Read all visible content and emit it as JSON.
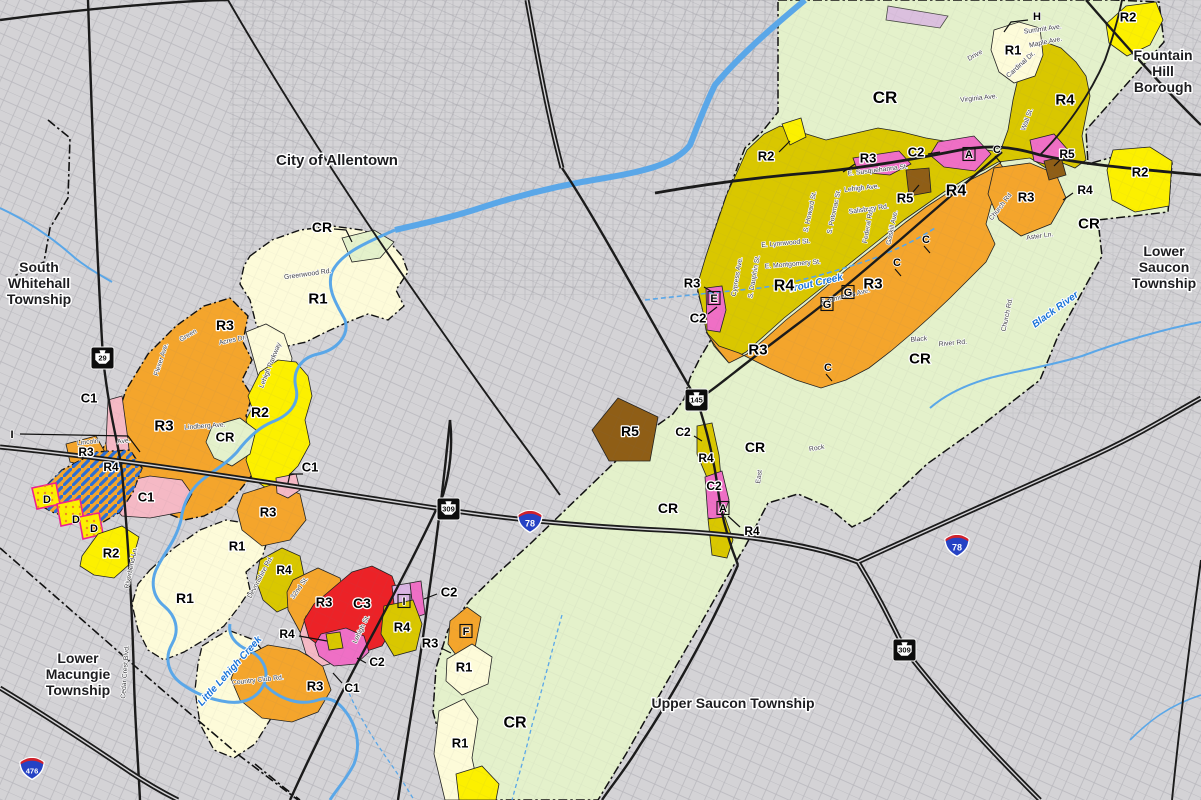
{
  "colors": {
    "background": "#d4d3d6",
    "road": "#1b1b1b",
    "water": "#5aa7e8",
    "grid": "#9b9ba1",
    "boundary": "#111111",
    "hatch_stripe": "#2b6fd6",
    "dot_overlay": "#f08c1e",
    "overlay_border": "#ef1f8f",
    "zones": {
      "CR": "#e4f1cb",
      "R1": "#fdfbd9",
      "R2": "#fcf000",
      "R3": "#f4a52c",
      "R4": "#d9c700",
      "R5": "#8f5e16",
      "C1": "#f5b9c5",
      "C2": "#ef6fc5",
      "C3": "#ec2227",
      "I": "#d9b4e3"
    }
  },
  "townships": [
    {
      "name": "City of Allentown",
      "lines": [
        "City of Allentown"
      ],
      "x": 337,
      "y": 165,
      "size": 15
    },
    {
      "name": "South Whitehall Township",
      "lines": [
        "South",
        "Whitehall",
        "Township"
      ],
      "x": 39,
      "y": 272,
      "size": 14
    },
    {
      "name": "Fountain Hill Borough",
      "lines": [
        "Fountain",
        "Hill",
        "Borough"
      ],
      "x": 1163,
      "y": 60,
      "size": 14
    },
    {
      "name": "Lower Saucon Township",
      "lines": [
        "Lower",
        "Saucon",
        "Township"
      ],
      "x": 1164,
      "y": 256,
      "size": 14
    },
    {
      "name": "Lower Macungie Township",
      "lines": [
        "Lower",
        "Macungie",
        "Township"
      ],
      "x": 78,
      "y": 663,
      "size": 14
    },
    {
      "name": "Upper Saucon Township",
      "lines": [
        "Upper Saucon Township"
      ],
      "x": 733,
      "y": 708,
      "size": 14
    }
  ],
  "zone_labels": [
    {
      "t": "CR",
      "x": 885,
      "y": 97,
      "s": 17
    },
    {
      "t": "R4",
      "x": 1065,
      "y": 99,
      "s": 15
    },
    {
      "t": "R1",
      "x": 1013,
      "y": 50,
      "s": 13
    },
    {
      "t": "R2",
      "x": 1128,
      "y": 17,
      "s": 13
    },
    {
      "t": "R2",
      "x": 766,
      "y": 156,
      "s": 13,
      "ptr": [
        [
          779,
          152
        ],
        [
          790,
          141
        ]
      ]
    },
    {
      "t": "R3",
      "x": 868,
      "y": 158,
      "s": 13,
      "ptr": [
        [
          855,
          164
        ],
        [
          843,
          172
        ]
      ]
    },
    {
      "t": "C2",
      "x": 916,
      "y": 152,
      "s": 13,
      "ptr": [
        [
          928,
          154
        ],
        [
          940,
          152
        ]
      ]
    },
    {
      "t": "R5",
      "x": 905,
      "y": 198,
      "s": 13,
      "ptr": [
        [
          913,
          192
        ],
        [
          919,
          185
        ]
      ]
    },
    {
      "t": "R5",
      "x": 1067,
      "y": 154,
      "s": 12,
      "ptr": [
        [
          1060,
          160
        ],
        [
          1054,
          166
        ]
      ]
    },
    {
      "t": "R4",
      "x": 956,
      "y": 190,
      "s": 16
    },
    {
      "t": "R3",
      "x": 1026,
      "y": 197,
      "s": 13
    },
    {
      "t": "R4",
      "x": 1085,
      "y": 190,
      "s": 12,
      "ptr": [
        [
          1073,
          193
        ],
        [
          1063,
          200
        ]
      ]
    },
    {
      "t": "R2",
      "x": 1140,
      "y": 172,
      "s": 13
    },
    {
      "t": "CR",
      "x": 1089,
      "y": 223,
      "s": 15
    },
    {
      "t": "R3",
      "x": 692,
      "y": 283,
      "s": 13,
      "ptr": [
        [
          704,
          287
        ],
        [
          714,
          293
        ]
      ]
    },
    {
      "t": "C2",
      "x": 698,
      "y": 318,
      "s": 13,
      "ptr": [
        [
          708,
          314
        ],
        [
          717,
          307
        ]
      ]
    },
    {
      "t": "R4",
      "x": 784,
      "y": 285,
      "s": 16
    },
    {
      "t": "R3",
      "x": 873,
      "y": 283,
      "s": 15
    },
    {
      "t": "R3",
      "x": 758,
      "y": 349,
      "s": 15
    },
    {
      "t": "CR",
      "x": 920,
      "y": 358,
      "s": 15
    },
    {
      "t": "R5",
      "x": 630,
      "y": 431,
      "s": 14
    },
    {
      "t": "C2",
      "x": 683,
      "y": 432,
      "s": 12,
      "ptr": [
        [
          694,
          436
        ],
        [
          702,
          441
        ]
      ]
    },
    {
      "t": "R4",
      "x": 706,
      "y": 458,
      "s": 12
    },
    {
      "t": "C2",
      "x": 714,
      "y": 486,
      "s": 12
    },
    {
      "t": "CR",
      "x": 755,
      "y": 447,
      "s": 14
    },
    {
      "t": "CR",
      "x": 668,
      "y": 508,
      "s": 14
    },
    {
      "t": "R4",
      "x": 752,
      "y": 531,
      "s": 12,
      "ptr": [
        [
          740,
          527
        ],
        [
          728,
          516
        ]
      ]
    },
    {
      "t": "CR",
      "x": 515,
      "y": 722,
      "s": 16
    },
    {
      "t": "R1",
      "x": 464,
      "y": 667,
      "s": 13
    },
    {
      "t": "R1",
      "x": 460,
      "y": 743,
      "s": 13
    },
    {
      "t": "R3",
      "x": 430,
      "y": 643,
      "s": 13,
      "ptr": [
        [
          441,
          648
        ],
        [
          451,
          653
        ]
      ]
    },
    {
      "t": "C2",
      "x": 449,
      "y": 592,
      "s": 13,
      "ptr": [
        [
          437,
          594
        ],
        [
          424,
          599
        ]
      ]
    },
    {
      "t": "R4",
      "x": 402,
      "y": 627,
      "s": 13
    },
    {
      "t": "C3",
      "x": 362,
      "y": 603,
      "s": 14
    },
    {
      "t": "R3",
      "x": 324,
      "y": 602,
      "s": 13
    },
    {
      "t": "R4",
      "x": 287,
      "y": 634,
      "s": 12,
      "ptr": [
        [
          299,
          636
        ],
        [
          327,
          641
        ]
      ]
    },
    {
      "t": "C2",
      "x": 377,
      "y": 662,
      "s": 12,
      "ptr": [
        [
          366,
          663
        ],
        [
          357,
          658
        ]
      ]
    },
    {
      "t": "C1",
      "x": 352,
      "y": 688,
      "s": 12,
      "ptr": [
        [
          342,
          683
        ],
        [
          333,
          673
        ]
      ]
    },
    {
      "t": "R3",
      "x": 315,
      "y": 686,
      "s": 13
    },
    {
      "t": "R4",
      "x": 284,
      "y": 570,
      "s": 12
    },
    {
      "t": "R3",
      "x": 268,
      "y": 512,
      "s": 13
    },
    {
      "t": "C1",
      "x": 310,
      "y": 467,
      "s": 13,
      "ptr": [
        [
          303,
          474
        ],
        [
          290,
          474
        ],
        [
          288,
          483
        ]
      ]
    },
    {
      "t": "C1",
      "x": 146,
      "y": 497,
      "s": 13
    },
    {
      "t": "R2",
      "x": 111,
      "y": 553,
      "s": 13
    },
    {
      "t": "R1",
      "x": 237,
      "y": 546,
      "s": 13
    },
    {
      "t": "R1",
      "x": 185,
      "y": 598,
      "s": 14
    },
    {
      "t": "R2",
      "x": 260,
      "y": 412,
      "s": 14
    },
    {
      "t": "CR",
      "x": 225,
      "y": 437,
      "s": 13
    },
    {
      "t": "R3",
      "x": 164,
      "y": 425,
      "s": 15
    },
    {
      "t": "R3",
      "x": 225,
      "y": 325,
      "s": 14
    },
    {
      "t": "C1",
      "x": 89,
      "y": 398,
      "s": 13
    },
    {
      "t": "R3",
      "x": 86,
      "y": 452,
      "s": 12
    },
    {
      "t": "R4",
      "x": 111,
      "y": 467,
      "s": 12
    },
    {
      "t": "R1",
      "x": 318,
      "y": 298,
      "s": 15
    },
    {
      "t": "CR",
      "x": 322,
      "y": 227,
      "s": 14,
      "ptr": [
        [
          334,
          229
        ],
        [
          346,
          230
        ],
        [
          352,
          242
        ]
      ]
    }
  ],
  "letter_markers": [
    {
      "t": "H",
      "x": 1037,
      "y": 16,
      "kind": "plain",
      "ptr": [
        [
          1028,
          20
        ],
        [
          1011,
          22
        ],
        [
          1004,
          32
        ]
      ]
    },
    {
      "t": "I",
      "x": 12,
      "y": 434,
      "kind": "plain",
      "ptr": [
        [
          20,
          434
        ],
        [
          128,
          436
        ],
        [
          140,
          452
        ]
      ]
    },
    {
      "t": "A",
      "x": 969,
      "y": 154,
      "kind": "boxed"
    },
    {
      "t": "C",
      "x": 997,
      "y": 149,
      "kind": "tick"
    },
    {
      "t": "C",
      "x": 926,
      "y": 239,
      "kind": "tick"
    },
    {
      "t": "C",
      "x": 897,
      "y": 262,
      "kind": "tick"
    },
    {
      "t": "C",
      "x": 828,
      "y": 367,
      "kind": "tick"
    },
    {
      "t": "G",
      "x": 848,
      "y": 292,
      "kind": "boxed"
    },
    {
      "t": "G",
      "x": 827,
      "y": 304,
      "kind": "boxed"
    },
    {
      "t": "E",
      "x": 714,
      "y": 298,
      "kind": "boxed"
    },
    {
      "t": "A",
      "x": 723,
      "y": 508,
      "kind": "boxed"
    },
    {
      "t": "F",
      "x": 466,
      "y": 631,
      "kind": "boxed"
    },
    {
      "t": "I",
      "x": 404,
      "y": 601,
      "kind": "boxed"
    },
    {
      "t": "D",
      "x": 47,
      "y": 499,
      "kind": "plain"
    },
    {
      "t": "D",
      "x": 76,
      "y": 519,
      "kind": "plain"
    },
    {
      "t": "D",
      "x": 94,
      "y": 528,
      "kind": "plain"
    }
  ],
  "street_labels": [
    {
      "t": "Greenwood Rd.",
      "x": 308,
      "y": 276,
      "r": -8
    },
    {
      "t": "Flexer Ave.",
      "x": 163,
      "y": 360,
      "r": -72
    },
    {
      "t": "Green",
      "x": 189,
      "y": 337,
      "r": -30
    },
    {
      "t": "Acres Dr.",
      "x": 233,
      "y": 342,
      "r": -12
    },
    {
      "t": "Lehigh Parkway",
      "x": 272,
      "y": 366,
      "r": -68
    },
    {
      "t": "Lindberg Ave.",
      "x": 205,
      "y": 428,
      "r": -4
    },
    {
      "t": "Lincoln",
      "x": 88,
      "y": 444,
      "r": -6
    },
    {
      "t": "Ave.",
      "x": 124,
      "y": 443,
      "r": -6
    },
    {
      "t": "32nd St.",
      "x": 301,
      "y": 589,
      "r": -55
    },
    {
      "t": "Devonshire Rd.",
      "x": 262,
      "y": 578,
      "r": -62
    },
    {
      "t": "Riverbend Ln.",
      "x": 133,
      "y": 568,
      "r": -78
    },
    {
      "t": "Country Club Rd.",
      "x": 258,
      "y": 682,
      "r": -6
    },
    {
      "t": "Cedar Crest Blvd.",
      "x": 127,
      "y": 672,
      "r": -86
    },
    {
      "t": "Lehigh St.",
      "x": 363,
      "y": 630,
      "r": -64
    },
    {
      "t": "Summit Ave.",
      "x": 1043,
      "y": 31,
      "r": -8
    },
    {
      "t": "Maple Ave.",
      "x": 1046,
      "y": 44,
      "r": -12
    },
    {
      "t": "Drive",
      "x": 976,
      "y": 57,
      "r": -30
    },
    {
      "t": "Virginia Ave.",
      "x": 979,
      "y": 100,
      "r": -6
    },
    {
      "t": "Cardinal Dr.",
      "x": 1022,
      "y": 66,
      "r": -42
    },
    {
      "t": "Wall St.",
      "x": 1029,
      "y": 120,
      "r": -70
    },
    {
      "t": "E. Susquehanna St.",
      "x": 878,
      "y": 172,
      "r": -7
    },
    {
      "t": "Lehigh Ave.",
      "x": 862,
      "y": 190,
      "r": -6
    },
    {
      "t": "Salisbury Rd.",
      "x": 869,
      "y": 211,
      "r": -8
    },
    {
      "t": "S. Howard St.",
      "x": 812,
      "y": 212,
      "r": -78
    },
    {
      "t": "S. Potomac St.",
      "x": 836,
      "y": 212,
      "r": -78
    },
    {
      "t": "Federal Rd.",
      "x": 870,
      "y": 226,
      "r": -80
    },
    {
      "t": "Gaskill Ave.",
      "x": 894,
      "y": 228,
      "r": -78
    },
    {
      "t": "E. Lynnwood St.",
      "x": 786,
      "y": 245,
      "r": -5
    },
    {
      "t": "E. Montgomery St.",
      "x": 793,
      "y": 266,
      "r": -5
    },
    {
      "t": "S. Dauphin St.",
      "x": 756,
      "y": 277,
      "r": -80
    },
    {
      "t": "Cypress Ave.",
      "x": 739,
      "y": 277,
      "r": -80
    },
    {
      "t": "E. Emmaus Ave.",
      "x": 846,
      "y": 298,
      "r": -14
    },
    {
      "t": "Black",
      "x": 919,
      "y": 341,
      "r": -5
    },
    {
      "t": "River Rd.",
      "x": 953,
      "y": 345,
      "r": -5
    },
    {
      "t": "Rock",
      "x": 817,
      "y": 450,
      "r": -10
    },
    {
      "t": "East",
      "x": 761,
      "y": 477,
      "r": -82
    },
    {
      "t": "Aster Ln.",
      "x": 1040,
      "y": 238,
      "r": -8
    },
    {
      "t": "Church Rd",
      "x": 1002,
      "y": 208,
      "r": -52
    },
    {
      "t": "Church Rd.",
      "x": 1009,
      "y": 315,
      "r": -78
    }
  ],
  "water_labels": [
    {
      "t": "Trout Creek",
      "x": 816,
      "y": 286,
      "r": -13
    },
    {
      "t": "Black River",
      "x": 1057,
      "y": 312,
      "r": -36
    },
    {
      "t": "Little Lehigh Creek",
      "x": 232,
      "y": 673,
      "r": -48
    }
  ],
  "shields": [
    {
      "kind": "keystone",
      "num": "29",
      "x": 103,
      "y": 358
    },
    {
      "kind": "keystone",
      "num": "309",
      "x": 449,
      "y": 509
    },
    {
      "kind": "keystone",
      "num": "145",
      "x": 697,
      "y": 400
    },
    {
      "kind": "keystone",
      "num": "309",
      "x": 905,
      "y": 650
    },
    {
      "kind": "interstate",
      "num": "78",
      "x": 530,
      "y": 521
    },
    {
      "kind": "interstate",
      "num": "78",
      "x": 957,
      "y": 545
    },
    {
      "kind": "interstate",
      "num": "476",
      "x": 32,
      "y": 768
    }
  ]
}
